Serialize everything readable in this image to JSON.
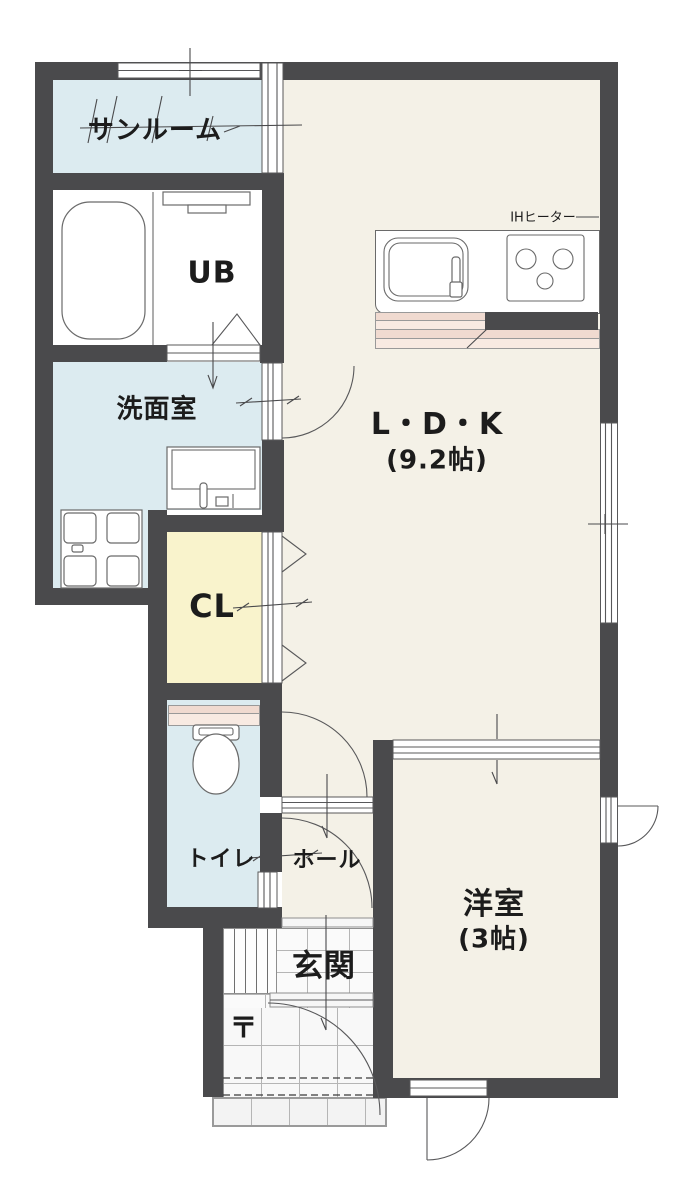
{
  "colors": {
    "wall": "#4a4a4c",
    "floor_cream": "#f4f1e7",
    "floor_blue": "#dcebf0",
    "floor_yellow": "#f9f3cc",
    "pink_dark": "#f0dad0",
    "pink_light": "#f8eae2",
    "line": "#58585a",
    "text": "#1c1c1c"
  },
  "rooms": {
    "sunroom": {
      "label": "サンルーム"
    },
    "unit_bath": {
      "label": "UB"
    },
    "washroom": {
      "label": "洗面室"
    },
    "closet": {
      "label": "CL"
    },
    "toilet": {
      "label": "トイレ"
    },
    "hall": {
      "label": "ホール"
    },
    "entrance": {
      "label": "玄関"
    },
    "ldk": {
      "label": "L・D・K",
      "size": "(9.2帖)"
    },
    "western_room": {
      "label": "洋室",
      "size": "(3帖)"
    }
  },
  "equipment": {
    "ih_heater": "IHヒーター",
    "postal_mark": "〒"
  }
}
